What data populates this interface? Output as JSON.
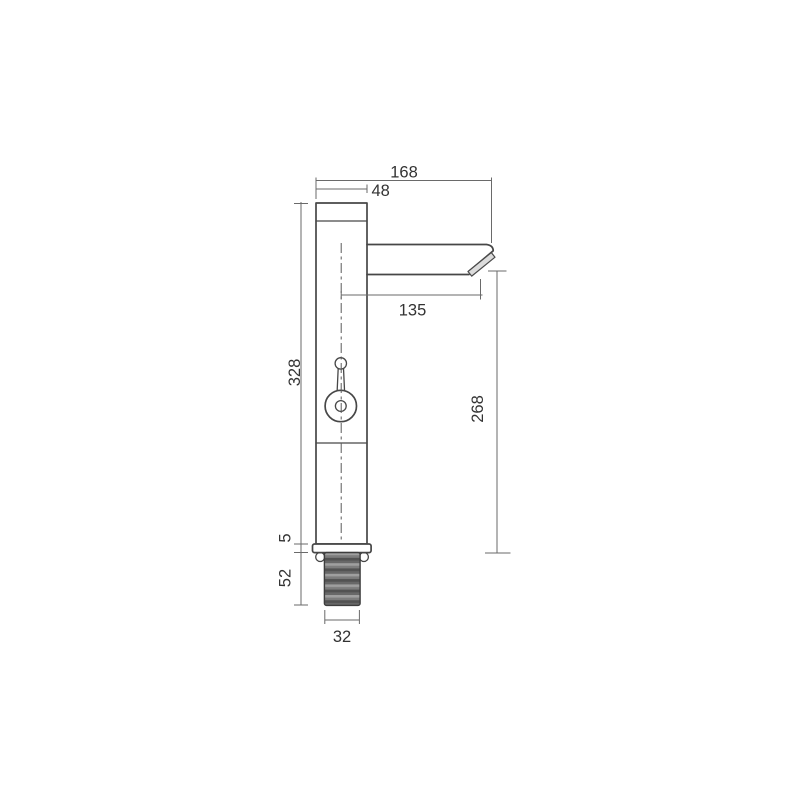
{
  "drawing": {
    "colors": {
      "background": "#ffffff",
      "object_line": "#474747",
      "dimension_line": "#6a6a6a",
      "text": "#333333",
      "aerator_fill": "#dcdcdc",
      "thread_base": "#7d7d7d",
      "thread_light": "#9f9f9f",
      "thread_mid": "#686868",
      "thread_dark": "#525252"
    },
    "dimensions": {
      "total_width": {
        "label": "168"
      },
      "body_width": {
        "label": "48"
      },
      "spout_reach": {
        "label": "135"
      },
      "total_height": {
        "label": "328"
      },
      "outlet_height": {
        "label": "268"
      },
      "base_thickness": {
        "label": "5"
      },
      "shank_length": {
        "label": "52"
      },
      "shank_width": {
        "label": "32"
      }
    }
  }
}
